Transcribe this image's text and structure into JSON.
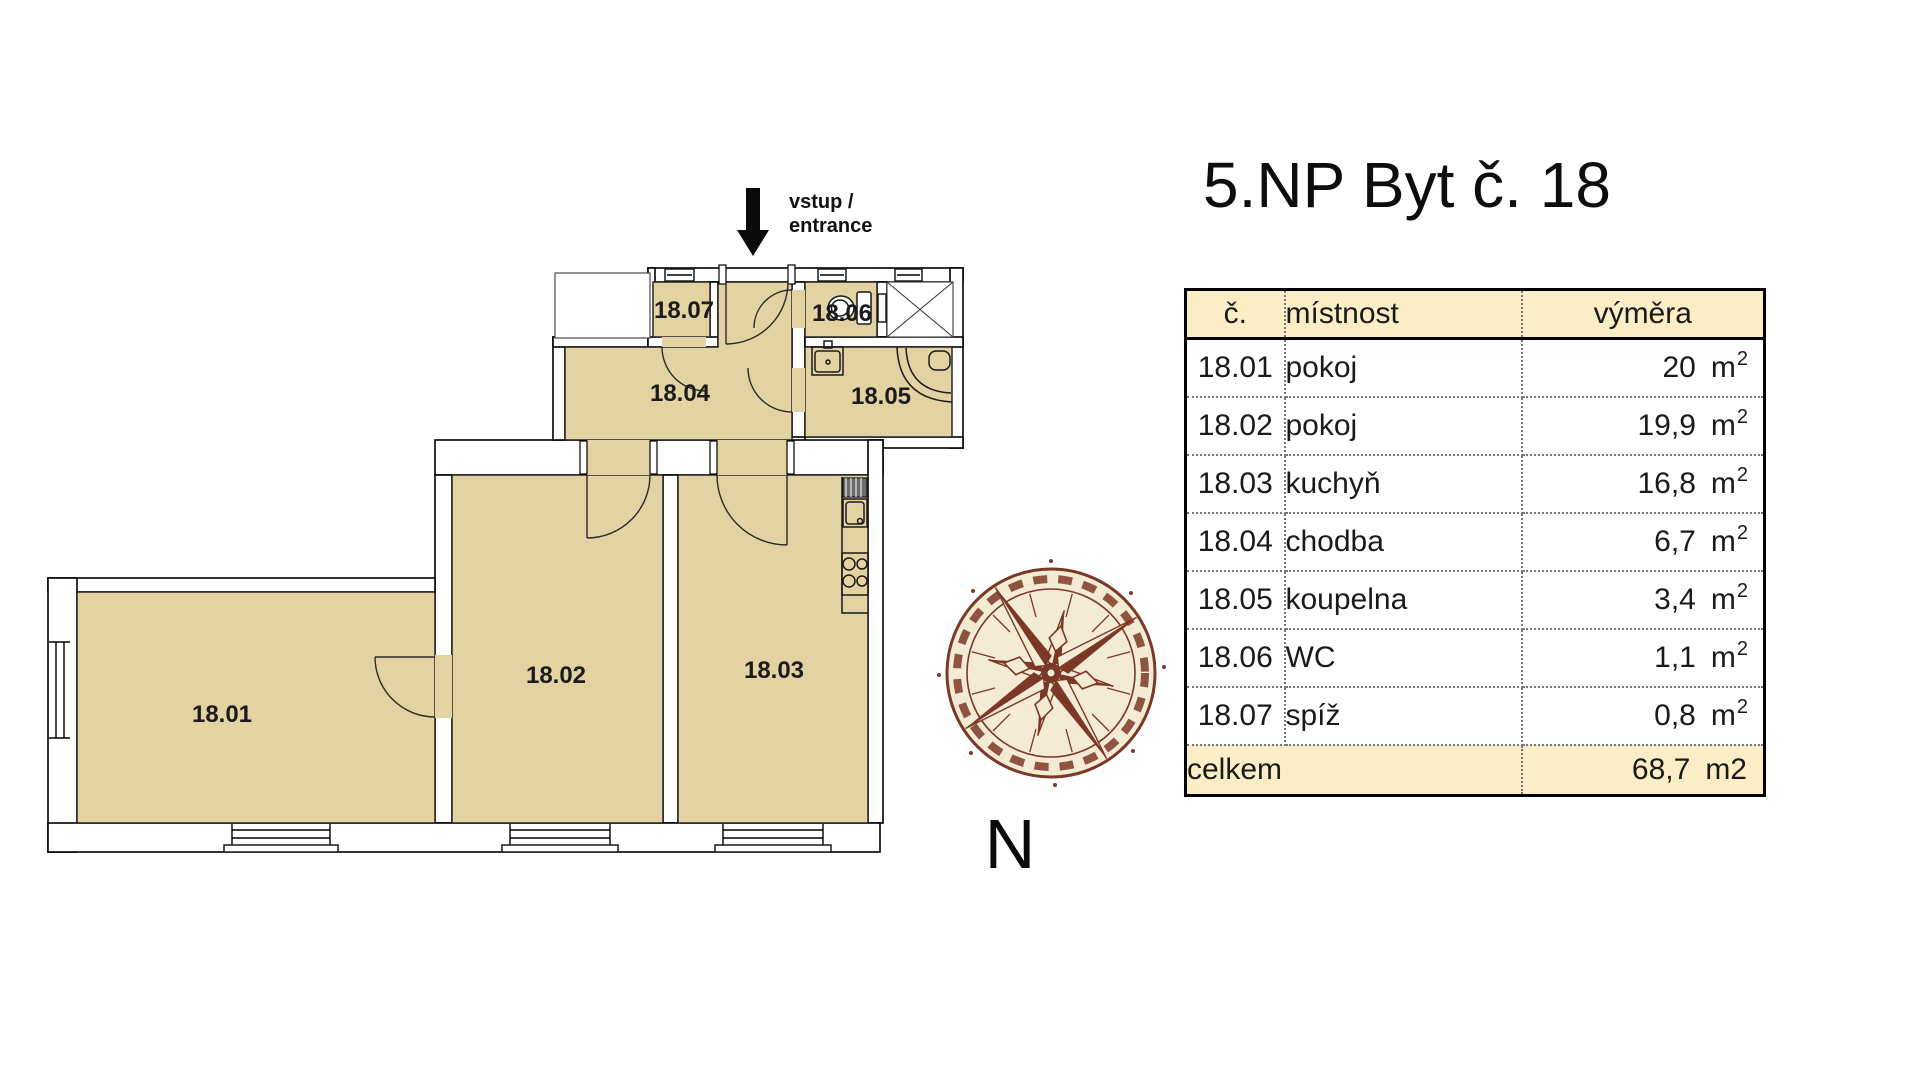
{
  "title": "5.NP Byt č. 18",
  "entrance": {
    "line1": "vstup /",
    "line2": "entrance"
  },
  "compass": {
    "north_label": "N"
  },
  "plan": {
    "room_labels": [
      "18.01",
      "18.02",
      "18.03",
      "18.04",
      "18.05",
      "18.06",
      "18.07"
    ]
  },
  "table": {
    "headers": {
      "no": "č.",
      "room": "místnost",
      "area": "výměra"
    },
    "rows": [
      {
        "no": "18.01",
        "room": "pokoj",
        "area": "20"
      },
      {
        "no": "18.02",
        "room": "pokoj",
        "area": "19,9"
      },
      {
        "no": "18.03",
        "room": "kuchyň",
        "area": "16,8"
      },
      {
        "no": "18.04",
        "room": "chodba",
        "area": "6,7"
      },
      {
        "no": "18.05",
        "room": "koupelna",
        "area": "3,4"
      },
      {
        "no": "18.06",
        "room": "WC",
        "area": "1,1"
      },
      {
        "no": "18.07",
        "room": "spíž",
        "area": "0,8"
      }
    ],
    "area_unit": "m",
    "area_sup": "2",
    "total_label": "celkem",
    "total_value": "68,7",
    "total_unit": "m2"
  },
  "colors": {
    "room_fill": "#e3d3a2",
    "table_header_fill": "#fbeec6",
    "compass_brown": "#7b3827",
    "compass_cream": "#f3ebd3",
    "wall_line": "#000000"
  }
}
